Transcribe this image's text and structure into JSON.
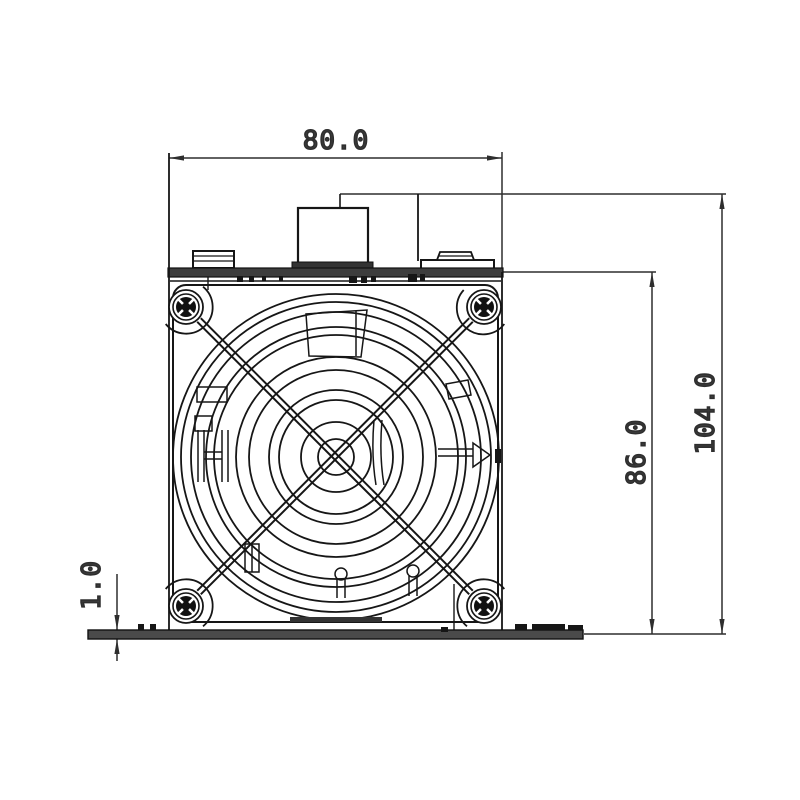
{
  "drawing": {
    "dimensions": {
      "width": "80.0",
      "overall_height": "104.0",
      "body_height": "86.0",
      "base_plate_thickness": "1.0"
    },
    "colors": {
      "line": "#161616",
      "dimension_line": "#2e2e2e",
      "dimension_text": "#3b3b3b",
      "bar_fill": "#3d3d3d",
      "plate_fill": "#4a4a4a",
      "background": "#ffffff"
    }
  }
}
